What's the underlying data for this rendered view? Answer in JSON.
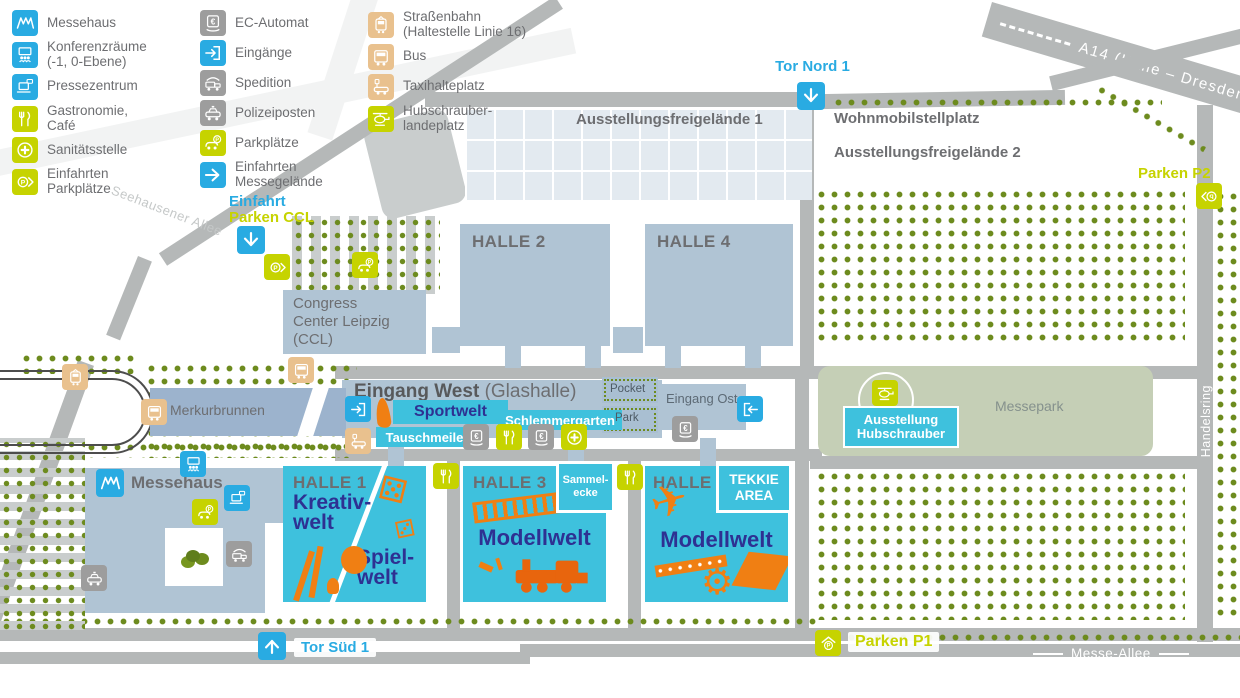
{
  "legend": {
    "col1": [
      {
        "icon": "messehaus-icon",
        "label": "Messehaus"
      },
      {
        "icon": "konferenzraeume-icon",
        "label": "Konferenzräume\n(-1, 0-Ebene)"
      },
      {
        "icon": "pressezentrum-icon",
        "label": "Pressezentrum"
      },
      {
        "icon": "gastronomie-icon",
        "label": "Gastronomie,\nCafé"
      },
      {
        "icon": "sanitaetsstelle-icon",
        "label": "Sanitätsstelle"
      },
      {
        "icon": "einfahrten-parkplaetze-icon",
        "label": "Einfahrten\nParkplätze"
      }
    ],
    "col2": [
      {
        "icon": "ec-automat-icon",
        "label": "EC-Automat"
      },
      {
        "icon": "eingaenge-icon",
        "label": "Eingänge"
      },
      {
        "icon": "spedition-icon",
        "label": "Spedition"
      },
      {
        "icon": "polizeiposten-icon",
        "label": "Polizeiposten"
      },
      {
        "icon": "parkplaetze-icon",
        "label": "Parkplätze"
      },
      {
        "icon": "einfahrten-messegelaende-icon",
        "label": "Einfahrten\nMessegelände"
      }
    ],
    "col3": [
      {
        "icon": "strassenbahn-icon",
        "label": "Straßenbahn\n(Haltestelle Linie 16)"
      },
      {
        "icon": "bus-icon",
        "label": "Bus"
      },
      {
        "icon": "taxihalteplatz-icon",
        "label": "Taxihalteplatz"
      },
      {
        "icon": "hubschrauberlandeplatz-icon",
        "label": "Hubschrauber-\nlandeplatz"
      }
    ]
  },
  "highway": {
    "a14": "A14 (Halle – Dresden)"
  },
  "streets": {
    "seehausener": "Seehausener Allee",
    "alte_duebener": "Alte Dübener Landstraße",
    "handelsring": "Handelsring",
    "messe_allee": "Messe-Allee"
  },
  "gates": {
    "tor_nord": "Tor Nord 1",
    "tor_sued": "Tor Süd 1",
    "einfahrt": "Einfahrt",
    "parken_ccl": "Parken CCL",
    "parken_p1": "Parken P1",
    "parken_p2": "Parken P2"
  },
  "areas": {
    "freigelaende1": "Ausstellungsfreigelände 1",
    "freigelaende2": "Ausstellungsfreigelände 2",
    "wohnmobil": "Wohnmobilstellplatz",
    "messepark": "Messepark",
    "merkurbrunnen": "Merkurbrunnen",
    "pocket": "Pocket",
    "park": "Park"
  },
  "buildings": {
    "halle2": "HALLE 2",
    "halle4": "HALLE 4",
    "ccl": "Congress\nCenter Leipzig\n(CCL)",
    "messehaus": "Messehaus",
    "eingang_west_bold": "Eingang West",
    "eingang_west_light": "(Glashalle)",
    "eingang_ost": "Eingang Ost"
  },
  "venues": {
    "sportwelt": "Sportwelt",
    "tauschmeile": "Tauschmeile",
    "schlemmergarten": "Schlemmergarten",
    "sammelecke": "Sammel-\necke",
    "ausstellung_hubschrauber": "Ausstellung\nHubschrauber"
  },
  "halls": {
    "halle1": {
      "name": "HALLE 1",
      "world_a": "Kreativ-\nwelt",
      "world_b": "Spiel-\nwelt"
    },
    "halle3": {
      "name": "HALLE 3",
      "world": "Modellwelt"
    },
    "halle5": {
      "name": "HALLE 5",
      "world": "Modellwelt",
      "badge": "TEKKIE\nAREA"
    }
  },
  "colors": {
    "accent_blue": "#29abe2",
    "accent_green": "#c6d300",
    "icon_gray": "#9d9d9d",
    "icon_tan": "#e9c18e",
    "hall_cyan": "#3ec1dd",
    "building": "#b0c4d4",
    "tree_green": "#6d8b1e",
    "doodle_orange": "#f07f13",
    "world_blue": "#2e3192",
    "road_gray": "#b5b8b8",
    "text_gray": "#6d6e71"
  }
}
